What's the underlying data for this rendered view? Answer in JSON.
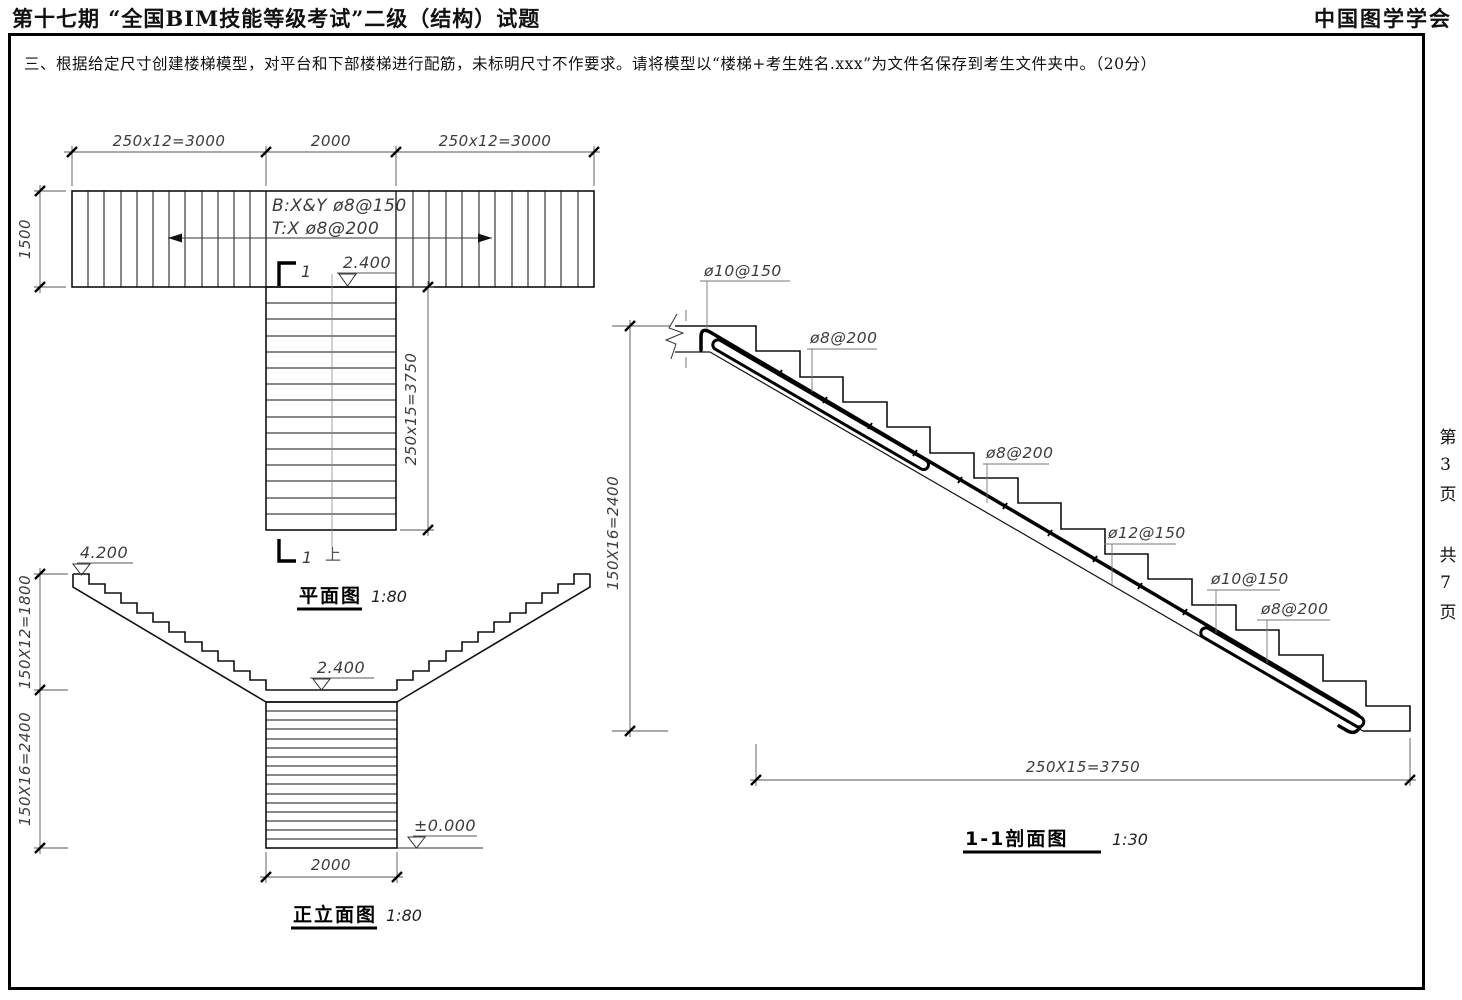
{
  "header": {
    "exam_title": "第十七期 “全国BIM技能等级考试”二级（结构）试题",
    "organization": "中国图学学会"
  },
  "instruction": {
    "text": "三、根据给定尺寸创建楼梯模型，对平台和下部楼梯进行配筋，未标明尺寸不作要求。请将模型以“楼梯+考生姓名.xxx”为文件名保存到考生文件夹中。（20分）"
  },
  "page_info": {
    "current_page": "第3页",
    "total_pages": "共7页"
  },
  "plan_view": {
    "title": "平面图",
    "scale": "1:80",
    "dims": {
      "top_left": "250x12=3000",
      "top_middle": "2000",
      "top_right": "250x12=3000",
      "left": "1500",
      "flight": "250x15=3750"
    },
    "notes": {
      "bottom_rebar": "B:X&Y ø8@150",
      "top_rebar": "T:X ø8@200"
    },
    "level": "2.400",
    "section_cut": "1",
    "up_label": "上"
  },
  "elevation_view": {
    "title": "正立面图",
    "scale": "1:80",
    "levels": {
      "top": "4.200",
      "landing": "2.400",
      "ground": "±0.000"
    },
    "dims": {
      "upper_flight": "150X12=1800",
      "lower_flight": "150X16=2400",
      "width": "2000"
    }
  },
  "section_view": {
    "title": "1-1剖面图",
    "scale": "1:30",
    "dims": {
      "height": "150X16=2400",
      "run": "250X15=3750"
    },
    "rebar": {
      "top_main": "ø10@150",
      "top_dist": "ø8@200",
      "mid_dist": "ø8@200",
      "mid_main": "ø12@150",
      "low_main": "ø10@150",
      "low_dist": "ø8@200"
    }
  },
  "colors": {
    "line": "#111111",
    "dim_line": "#444444"
  }
}
